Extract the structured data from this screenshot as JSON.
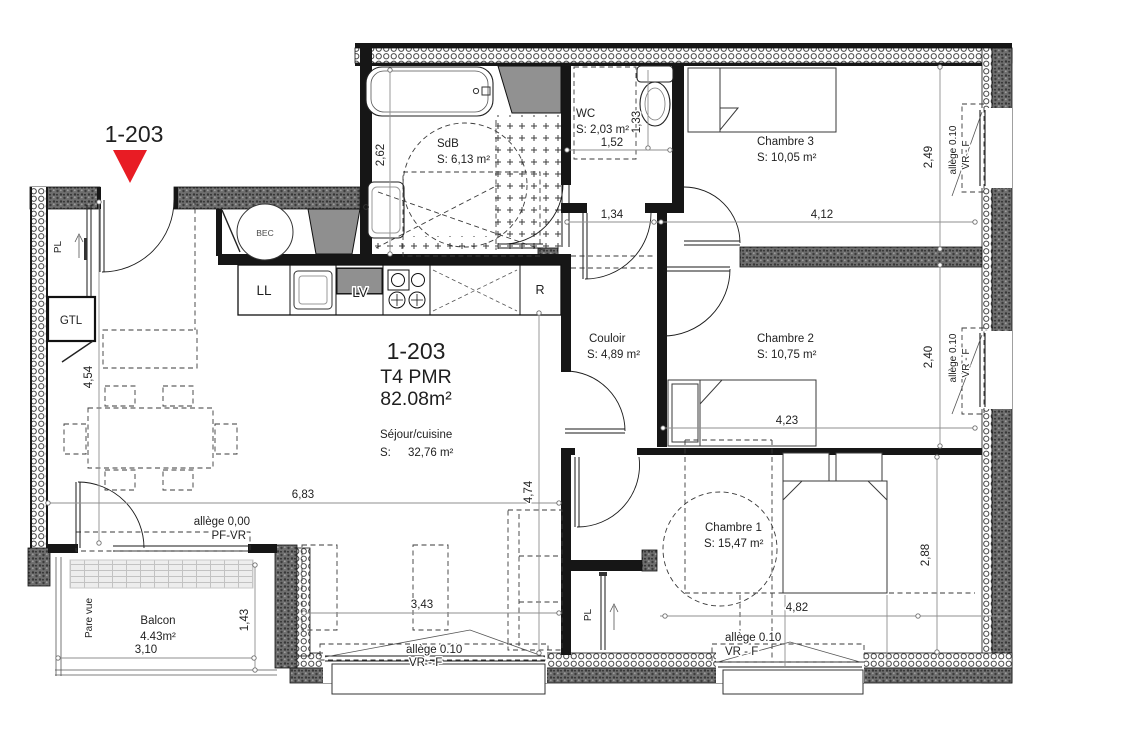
{
  "marker": {
    "label": "1-203"
  },
  "title_block": {
    "unit": "1-203",
    "type": "T4 PMR",
    "total_area": "82.08m²"
  },
  "rooms": {
    "sdb": {
      "name": "SdB",
      "area": "S: 6,13 m²"
    },
    "wc": {
      "name": "WC",
      "area": "S: 2,03 m²"
    },
    "chambre3": {
      "name": "Chambre 3",
      "area": "S: 10,05 m²"
    },
    "couloir": {
      "name": "Couloir",
      "area": "S: 4,89 m²"
    },
    "chambre2": {
      "name": "Chambre 2",
      "area": "S: 10,75 m²"
    },
    "chambre1": {
      "name": "Chambre 1",
      "area": "S: 15,47 m²"
    },
    "sejour": {
      "name": "Séjour/cuisine",
      "area_prefix": "S:",
      "area_value": "32,76 m²"
    },
    "balcon": {
      "name": "Balcon",
      "area": "4.43m²"
    }
  },
  "fixtures": {
    "washing_machine": "LL",
    "dishwasher": "LV",
    "fridge": "R",
    "water_heater": "BEC",
    "distribution_board": "GTL",
    "closet_entry": "PL",
    "closet_chambre1": "PL",
    "privacy_screen": "Pare vue"
  },
  "dimensions": {
    "sdb_height": "2,62",
    "wc_height": "1,33",
    "wc_width": "1,52",
    "couloir_width": "1,34",
    "chambre3_width": "4,12",
    "chambre3_height": "2,49",
    "chambre2_width": "4,23",
    "chambre2_height": "2,40",
    "chambre1_width": "4,82",
    "chambre1_height": "2,88",
    "sejour_width": "6,83",
    "sejour_height": "4,54",
    "sejour_height2": "4,74",
    "sejour_window_width": "3,43",
    "balcon_height": "1,43",
    "balcon_width": "3,10"
  },
  "window_labels": {
    "balcony_line1": "allège 0,00",
    "balcony_line2": "PF-VR",
    "sejour_line1": "allège  0.10",
    "sejour_line2": "VR - F",
    "chambre1_line1": "allège  0.10",
    "chambre1_line2": "VR - F",
    "chambre3_line1": "allège  0.10",
    "chambre3_line2": "VR - F",
    "chambre2_line1": "allège  0.10",
    "chambre2_line2": "VR - F"
  },
  "colors": {
    "marker_red": "#e81c24",
    "wall_dark": "#161616",
    "dim_gray": "#8f8f8f"
  }
}
